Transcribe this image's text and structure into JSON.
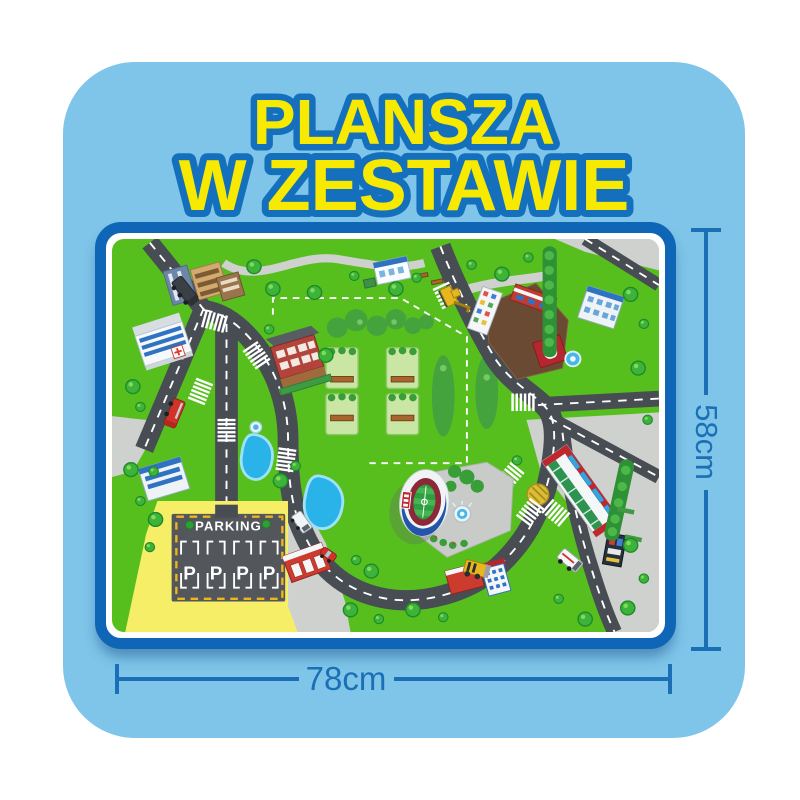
{
  "title": {
    "line1": "PLANSZA",
    "line2": "W ZESTAWIE"
  },
  "dimensions": {
    "height": "58cm",
    "width": "78cm"
  },
  "mat": {
    "parking_label": "PARKING",
    "stalls": [
      "P",
      "P",
      "P",
      "P"
    ]
  },
  "colors": {
    "card_bg": "#7ec5e9",
    "title_fill": "#f7ea00",
    "title_outline": "#1470bd",
    "mat_border": "#1066b6",
    "dimension_accent": "#1b6fb5",
    "grass": "#56bf1e",
    "road": "#474d52",
    "parking_asphalt": "#53575b",
    "parking_ground": "#f6ee67",
    "parking_dash": "#f0b41e",
    "pond": "#29b3e8"
  }
}
